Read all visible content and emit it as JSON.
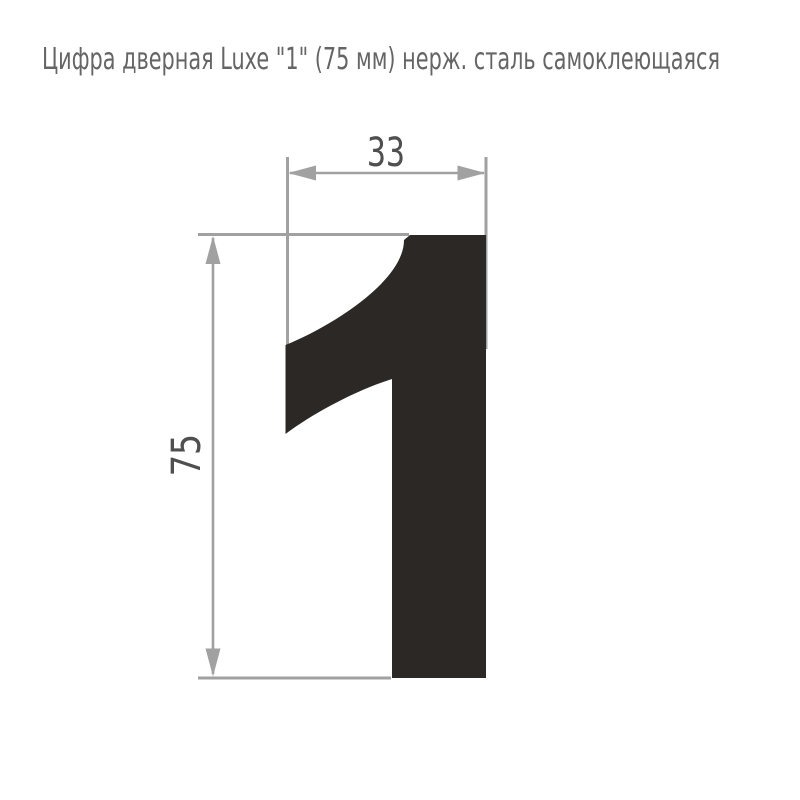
{
  "title": {
    "text": "Цифра дверная Luxe \"1\" (75 мм) нерж. сталь самоклеющаяся"
  },
  "drawing": {
    "digit_label": "1",
    "width_mm": "33",
    "height_mm": "75",
    "units": "mm"
  },
  "colors": {
    "background": "#ffffff",
    "digit": "#2b2825",
    "dimension_line": "#a1a1a1",
    "dimension_text": "#4f4f4f",
    "title_text": "#656565"
  }
}
